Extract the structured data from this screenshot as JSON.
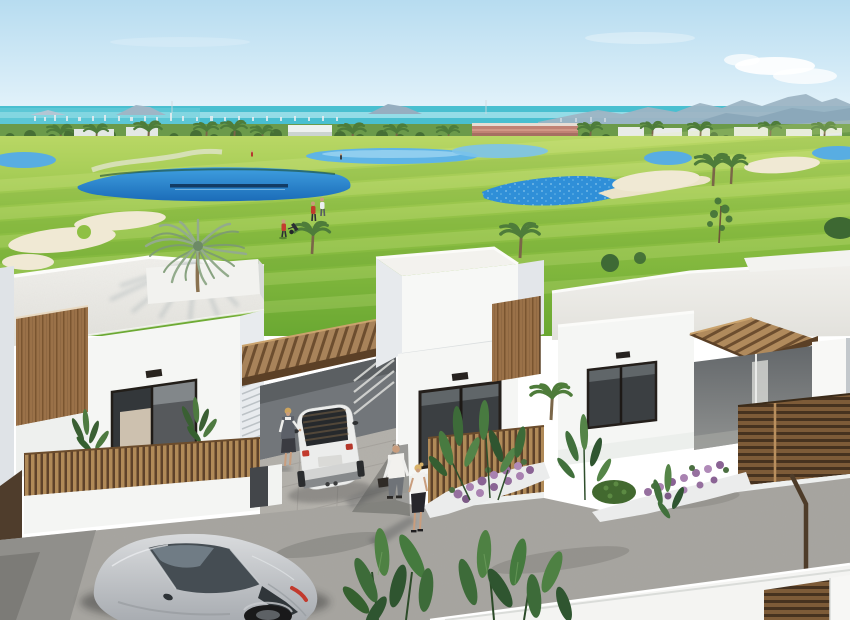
{
  "scene": {
    "type": "architectural-3d-render",
    "description": "Aerial view of three new-build modern white flat-roof villas with wooden pergolas and slat fences, fronting a golf course with lakes and sand bunkers, sea and mountains on the horizon",
    "weather": "sunny, clear sky with one cloud at top right"
  },
  "colors": {
    "sky_top": "#b7dcf0",
    "sky_bottom": "#eef8fd",
    "sea": "#49bfd0",
    "sea_light": "#a8e4ec",
    "mountain": "#9db4c4",
    "grass_far": "#b9d765",
    "grass_near": "#6aa832",
    "lake_top": "#3f9fe0",
    "lake_bottom": "#1b6cb8",
    "pond": "#58ade2",
    "sand": "#f0e9d4",
    "roof_light": "#f1f0ec",
    "roof_shade": "#e2e1dc",
    "wall_white": "#f5f6f4",
    "wall_shade": "#e3e6ea",
    "glass": "#3b3f42",
    "curtain": "#cdc1af",
    "wood": "#9a7148",
    "wood_dark": "#5b4026",
    "street": "#a7a5a0",
    "driveway": "#b4b1ab",
    "mini_white": "#ecedec",
    "car_light": "#d9dbdd",
    "car_dark": "#a9adb2",
    "car_glass": "#454d53",
    "taillight": "#c23a2d",
    "leaf": "#3d6b39",
    "leaf_light": "#4e8143",
    "flower": "#96709f",
    "skin": "#c99d7d",
    "golfer_red": "#c23b2f"
  },
  "objects": {
    "villas": {
      "count": 3,
      "style": "white cubic flat-roof",
      "features": [
        "wood pergola carports",
        "vertical slat fences",
        "large dark glass windows",
        "roof planter with palm"
      ]
    },
    "vehicles": [
      {
        "name": "white-mini-hatchback",
        "location": "center driveway under pergola"
      },
      {
        "name": "silver-sports-coupe",
        "location": "foreground street bottom left"
      }
    ],
    "people": {
      "golfers_on_course": 4,
      "pedestrians_walking": 2,
      "person_at_car_door": 1
    },
    "golf": {
      "lakes": 2,
      "ponds": 4,
      "bunkers": 5,
      "flag": 0
    },
    "vegetation": [
      "large sage palm in roof planter",
      "tall slim palm",
      "shore palm row",
      "banana / strelitzia beds",
      "purple flower beds",
      "round shrub"
    ],
    "distant": [
      "white building",
      "pink apartment block",
      "white villa row",
      "city skyline strip",
      "mountain ridges",
      "islands"
    ]
  }
}
